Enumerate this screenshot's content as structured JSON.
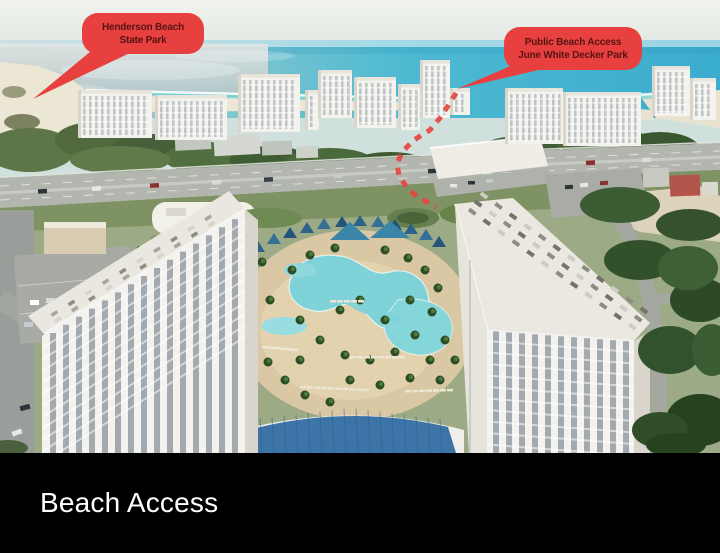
{
  "photo": {
    "scene": "Aerial view of a Gulf-front resort: twin white condo towers around a lagoon pool complex, a row of beachfront high-rises, a highway, white-sand beach and emerald water",
    "callouts": [
      {
        "id": "henderson-beach-state-park",
        "lines": [
          "Henderson Beach",
          "State Park"
        ]
      },
      {
        "id": "public-beach-access",
        "lines": [
          "Public Beach Access",
          "June White Decker Park"
        ]
      }
    ],
    "route_marker": {
      "style": "red dashed walking path to public beach access"
    }
  },
  "caption": {
    "title": "Beach Access"
  },
  "colors": {
    "callout_bg": "#e8403f",
    "callout_text": "#551413",
    "route_red": "#e64540",
    "caption_bg": "#000000",
    "caption_text": "#ffffff"
  }
}
